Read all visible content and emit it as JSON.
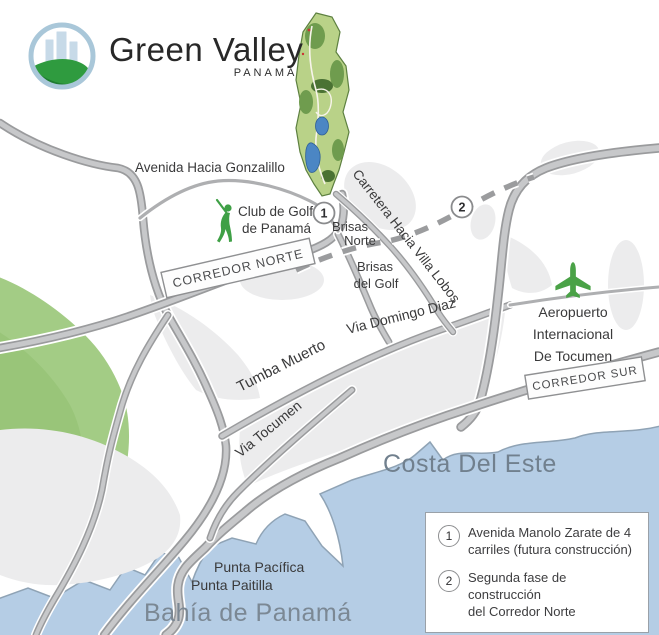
{
  "logo": {
    "title": "Green Valley",
    "subtitle": "PANAMÁ"
  },
  "map": {
    "labels": {
      "gonzalillo": "Avenida Hacia Gonzalillo",
      "golf_line1": "Club de Golf",
      "golf_line2": "de Panamá",
      "carretera": "Carretera Hacia Villa Lobos",
      "brisas_norte_line1": "Brisas",
      "brisas_norte_line2": "Norte",
      "brisas_golf_line1": "Brisas",
      "brisas_golf_line2": "del Golf",
      "corredor_norte": "CORREDOR NORTE",
      "via_domingo": "Via Domingo Diaz",
      "tumba_muerto": "Tumba Muerto",
      "corredor_sur": "CORREDOR SUR",
      "via_tocumen": "Via Tocumen",
      "aeropuerto_line1": "Aeropuerto",
      "aeropuerto_line2": "Internacional",
      "aeropuerto_line3": "De Tocumen",
      "costa_del_este": "Costa Del Este",
      "punta_pacifica": "Punta Pacífica",
      "punta_paitilla": "Punta Paitilla",
      "bahia": "Bahía de Panamá"
    },
    "markers": {
      "marker1": "1",
      "marker2": "2"
    }
  },
  "legend": {
    "items": [
      {
        "num": "1",
        "line1": "Avenida Manolo Zarate de 4",
        "line2": "carriles (futura construcción)"
      },
      {
        "num": "2",
        "line1": "Segunda fase de construcción",
        "line2": "del Corredor Norte"
      }
    ]
  },
  "colors": {
    "water": "#b5cde5",
    "coastline": "#8fa3b5",
    "park_green": "#a3cc85",
    "urban_gray": "#ececed",
    "road_casing": "#9a9b9d",
    "road_fill": "#c7c8ca",
    "dashed_road": "#9b9c9e",
    "icon_green": "#3fa046",
    "label_text": "#3a3a3b",
    "water_text": "#71808e",
    "masterplan_green": "#b9d288",
    "masterplan_lake": "#4b86c4",
    "logo_ring": "#a9c7d9",
    "logo_hill": "#2f9b3f"
  }
}
